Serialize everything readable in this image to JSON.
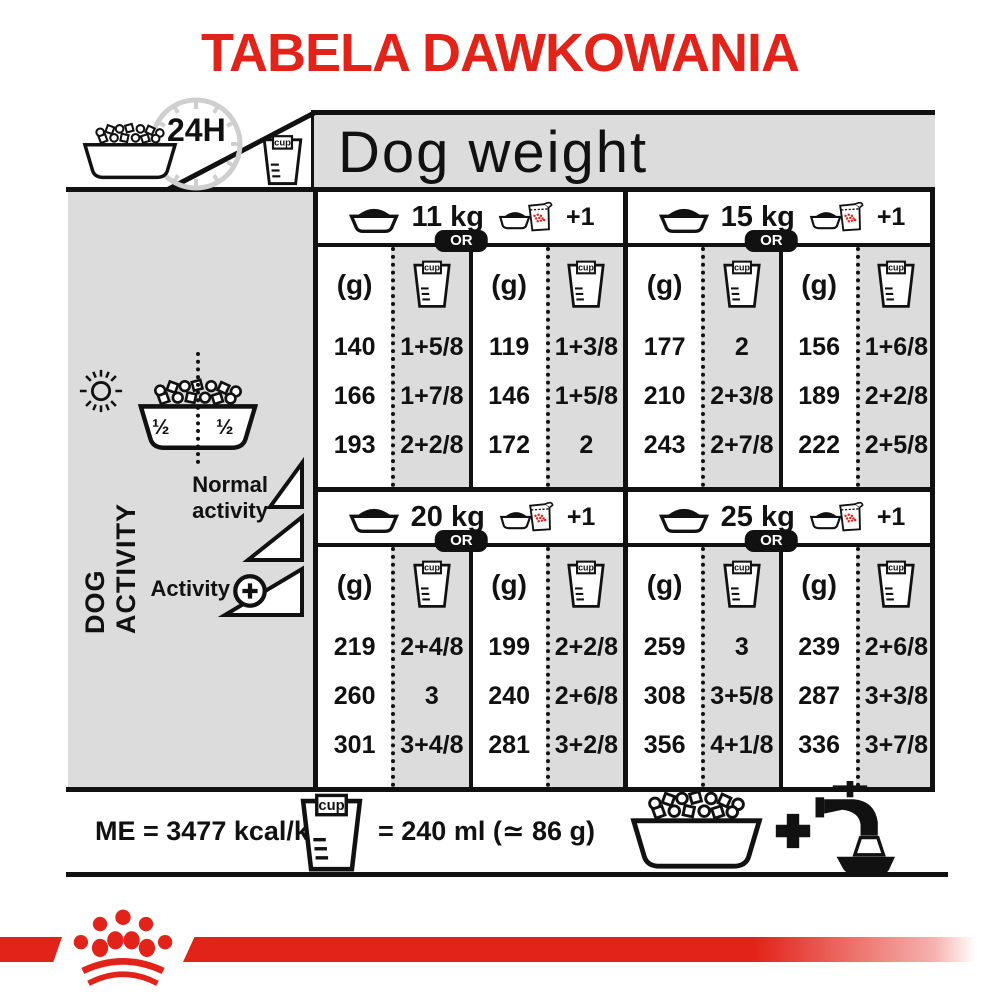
{
  "title": "TABELA DAWKOWANIA",
  "header": {
    "hours": "24H",
    "cup": "cup",
    "dog_weight": "Dog weight"
  },
  "sidebar": {
    "half_left": "½",
    "half_right": "½",
    "axis": "DOG ACTIVITY",
    "normal": "Normal activity",
    "activity": "Activity"
  },
  "table": {
    "or": "OR",
    "grams": "(g)",
    "cup": "cup",
    "plus_one": "+1",
    "sections": [
      {
        "weight": "11 kg",
        "rows": [
          [
            "140",
            "1+5/8",
            "119",
            "1+3/8"
          ],
          [
            "166",
            "1+7/8",
            "146",
            "1+5/8"
          ],
          [
            "193",
            "2+2/8",
            "172",
            "2"
          ]
        ]
      },
      {
        "weight": "15 kg",
        "rows": [
          [
            "177",
            "2",
            "156",
            "1+6/8"
          ],
          [
            "210",
            "2+3/8",
            "189",
            "2+2/8"
          ],
          [
            "243",
            "2+7/8",
            "222",
            "2+5/8"
          ]
        ]
      },
      {
        "weight": "20 kg",
        "rows": [
          [
            "219",
            "2+4/8",
            "199",
            "2+2/8"
          ],
          [
            "260",
            "3",
            "240",
            "2+6/8"
          ],
          [
            "301",
            "3+4/8",
            "281",
            "3+2/8"
          ]
        ]
      },
      {
        "weight": "25 kg",
        "rows": [
          [
            "259",
            "3",
            "239",
            "2+6/8"
          ],
          [
            "308",
            "3+5/8",
            "287",
            "3+3/8"
          ],
          [
            "356",
            "4+1/8",
            "336",
            "3+7/8"
          ]
        ]
      }
    ]
  },
  "footer": {
    "me": "ME = 3477 kcal/kg",
    "equiv": "= 240 ml (≃ 86 g)",
    "cup": "cup"
  },
  "colors": {
    "accent_red": "#E2231A",
    "panel_gray": "#DCDCDC",
    "ink": "#111111"
  }
}
